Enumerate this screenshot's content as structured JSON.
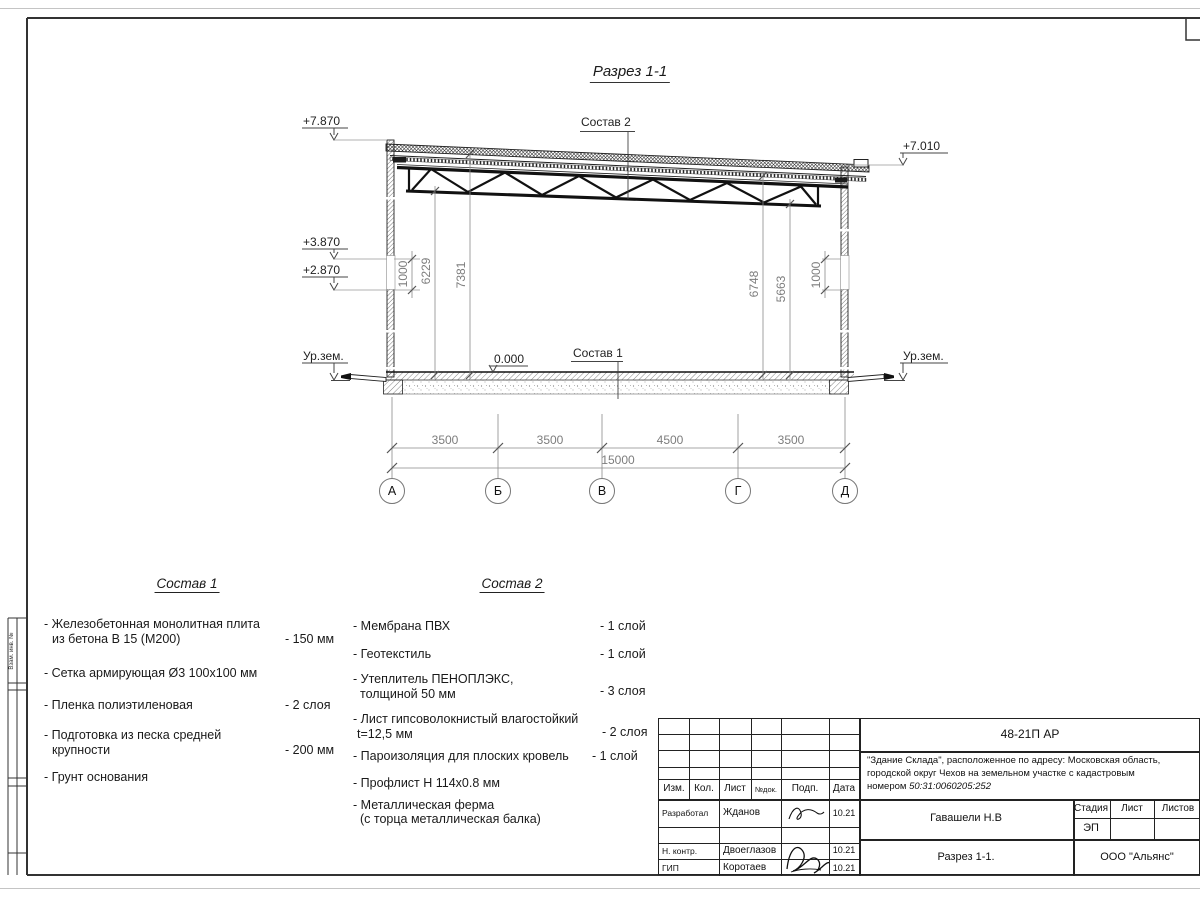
{
  "sheet": {
    "side_label": "Взам. инв. №"
  },
  "drawing": {
    "title": "Разрез 1-1",
    "elev_top_left": "+7.870",
    "elev_mid1": "+3.870",
    "elev_mid2": "+2.870",
    "elev_ground_left": "Ур.зем.",
    "elev_zero": "0.000",
    "elev_top_right": "+7.010",
    "elev_ground_right": "Ур.зем.",
    "label_sostav1": "Состав 1",
    "label_sostav2": "Состав 2",
    "dim_v": [
      "1000",
      "6229",
      "7381",
      "6748",
      "5663",
      "1000"
    ],
    "dim_h": [
      "3500",
      "3500",
      "4500",
      "3500"
    ],
    "dim_total": "15000",
    "axes": [
      "А",
      "Б",
      "В",
      "Г",
      "Д"
    ]
  },
  "sostav1": {
    "title": "Состав 1",
    "items": [
      {
        "l1": "- Железобетонная  монолитная плита",
        "l2": "из бетона В 15 (М200)",
        "val": "- 150 мм"
      },
      {
        "l1": "- Сетка армирующая Ø3 100х100 мм",
        "l2": "",
        "val": ""
      },
      {
        "l1": "- Пленка полиэтиленовая",
        "l2": "",
        "val": "-  2 слоя"
      },
      {
        "l1": "- Подготовка из песка средней",
        "l2": "крупности",
        "val": "- 200 мм"
      },
      {
        "l1": "- Грунт основания",
        "l2": "",
        "val": ""
      }
    ]
  },
  "sostav2": {
    "title": "Состав 2",
    "items": [
      {
        "l1": "- Мембрана ПВХ",
        "l2": "",
        "val": "- 1 слой"
      },
      {
        "l1": "- Геотекстиль",
        "l2": "",
        "val": "- 1 слой"
      },
      {
        "l1": "- Утеплитель ПЕНОПЛЭКС,",
        "l2": "толщиной 50 мм",
        "val": "- 3 слоя"
      },
      {
        "l1": "- Лист гипсоволокнистый влагостойкий",
        "l2": "t=12,5 мм",
        "val": "- 2 слоя"
      },
      {
        "l1": "- Пароизоляция для плоских кровель",
        "l2": "",
        "val": "- 1 слой"
      },
      {
        "l1": "- Профлист Н 114х0.8 мм",
        "l2": "",
        "val": ""
      },
      {
        "l1": "- Металлическая ферма",
        "l2": "(с торца металлическая балка)",
        "val": ""
      }
    ]
  },
  "title_block": {
    "code": "48-21П АР",
    "address_l1": "\"Здание Склада\", расположенное по адресу: Московская область,",
    "address_l2": "городской округ Чехов на земельном участке с кадастровым",
    "address_l3_prefix": "номером ",
    "address_l3_num": "50:31:0060205:252",
    "col_izm": "Изм.",
    "col_kol": "Кол.",
    "col_list": "Лист",
    "col_doc": "№док.",
    "col_podp": "Подп.",
    "col_data": "Дата",
    "row1_role": "Разработал",
    "row1_name": "Жданов",
    "row1_date": "10.21",
    "row2_role": "Н. контр.",
    "row2_name": "Двоеглазов",
    "row2_date": "10.21",
    "row3_role": "ГИП",
    "row3_name": "Коротаев",
    "row3_date": "10.21",
    "chief": "Гавашели Н.В",
    "stage_h": "Стадия",
    "sheet_h": "Лист",
    "sheets_h": "Листов",
    "stage_v": "ЭП",
    "doc_title": "Разрез 1-1.",
    "company": "ООО \"Альянс\""
  }
}
